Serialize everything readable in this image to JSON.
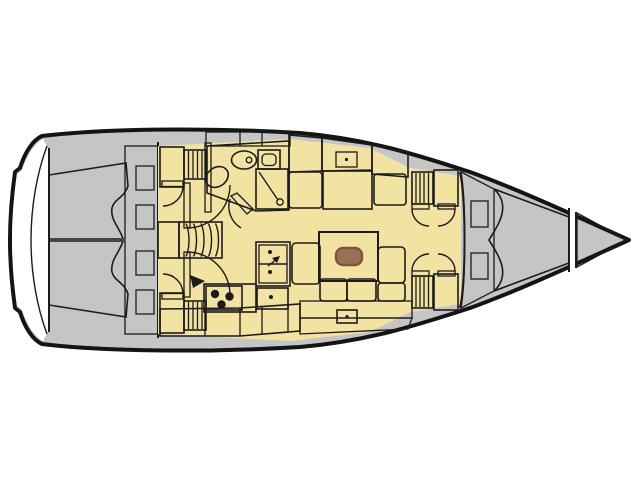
{
  "meta": {
    "plan_type": "sailboat-interior-floorplan",
    "orientation": "bow-right",
    "visible_text": []
  },
  "palette": {
    "background": "#ffffff",
    "outline": "#1b1b1b",
    "hull_line": "#141414",
    "deck": "#c5c5c5",
    "furniture": "#d8d8d8",
    "floor": "#f2e3a2",
    "bed": "#f3b377",
    "cushion": "#d9bba7",
    "wood": "#9a7156",
    "wood_panel": "#8d6750",
    "wood_dark": "#7a5640",
    "bath": "#d5e4ed",
    "white": "#ffffff",
    "black": "#1a1a1a"
  },
  "icons": {
    "toilet-icon": "oval-with-flush-dot",
    "washbasin-icon": "rounded-bowl",
    "vanity-sink-icon": "square-with-rounded-basin",
    "shower-icon": "square-with-diagonal-hose-and-drain",
    "stove-icon": "three-burner-dots",
    "galley-sink-icon": "double-square-with-drain-dots-and-faucet-arrow",
    "fridge-icon": "square-with-drain-dot",
    "faucet-icon": "small-black-triangle",
    "companionway-steps-icon": "curved-slats",
    "hanging-locker-icon": "vertical-slats",
    "door-swing-icon": "quarter-arc-with-leaf"
  }
}
